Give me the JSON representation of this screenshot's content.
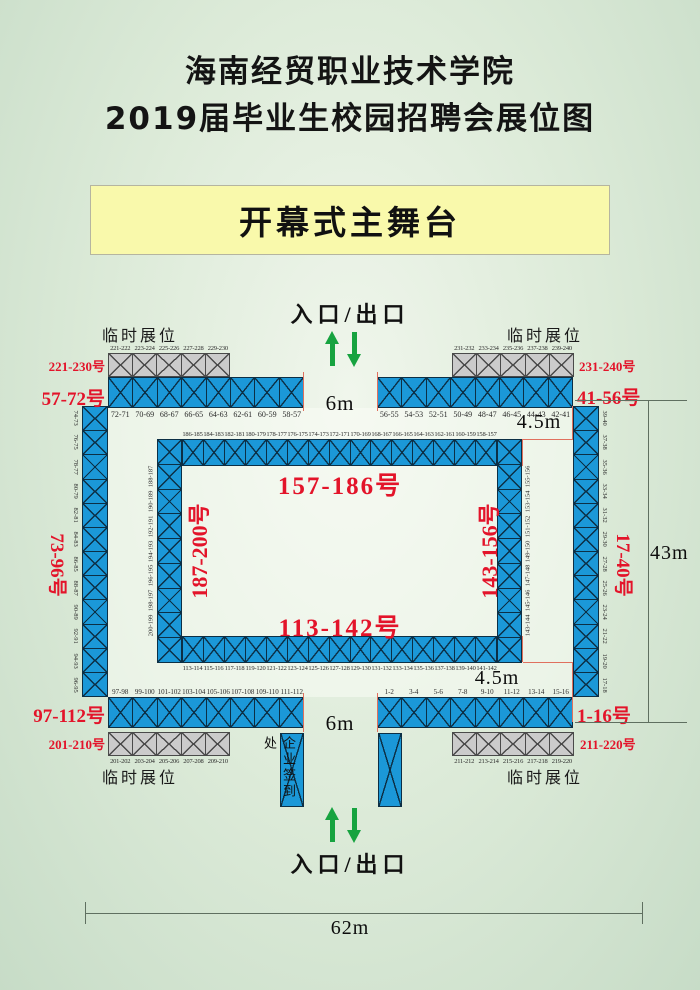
{
  "title": {
    "line1": "海南经贸职业技术学院",
    "line2": "2019届毕业生校园招聘会展位图"
  },
  "stage": {
    "label": "开幕式主舞台"
  },
  "entrance": {
    "top": "入口/出口",
    "bottom": "入口/出口"
  },
  "checkin": {
    "label": "企业签到处"
  },
  "labels": {
    "temp": "临时展位"
  },
  "dims": {
    "gap_top": "6m",
    "gap_bottom": "6m",
    "aisle_top": "4.5m",
    "aisle_bottom": "4.5m",
    "height": "43m",
    "width": "62m"
  },
  "zones": {
    "temp_top_left": {
      "range": "221-230号",
      "cells": [
        "221-222",
        "223-224",
        "225-226",
        "227-228",
        "229-230"
      ]
    },
    "temp_top_right": {
      "range": "231-240号",
      "cells": [
        "231-232",
        "233-234",
        "235-236",
        "237-238",
        "239-240"
      ]
    },
    "temp_bottom_left": {
      "range": "201-210号",
      "cells": [
        "201-202",
        "203-204",
        "205-206",
        "207-208",
        "209-210"
      ]
    },
    "temp_bottom_right": {
      "range": "211-220号",
      "cells": [
        "211-212",
        "213-214",
        "215-216",
        "217-218",
        "219-220"
      ]
    },
    "outer_top_left": {
      "range": "57-72号",
      "cells": [
        "72-71",
        "70-69",
        "68-67",
        "66-65",
        "64-63",
        "62-61",
        "60-59",
        "58-57"
      ]
    },
    "outer_top_right": {
      "range": "41-56号",
      "cells": [
        "56-55",
        "54-53",
        "52-51",
        "50-49",
        "48-47",
        "46-45",
        "44-43",
        "42-41"
      ]
    },
    "outer_left": {
      "range": "73-96号",
      "cells": [
        "74-73",
        "76-75",
        "78-77",
        "80-79",
        "82-81",
        "84-83",
        "86-85",
        "88-87",
        "90-89",
        "92-91",
        "94-93",
        "96-95"
      ]
    },
    "outer_right": {
      "range": "17-40号",
      "cells": [
        "39-40",
        "37-38",
        "35-36",
        "33-34",
        "31-32",
        "29-30",
        "27-28",
        "25-26",
        "23-24",
        "21-22",
        "19-20",
        "17-18"
      ]
    },
    "outer_bottom_left": {
      "range": "97-112号",
      "cells": [
        "97-98",
        "99-100",
        "101-102",
        "103-104",
        "105-106",
        "107-108",
        "109-110",
        "111-112"
      ]
    },
    "outer_bottom_right": {
      "range": "1-16号",
      "cells": [
        "1-2",
        "3-4",
        "5-6",
        "7-8",
        "9-10",
        "11-12",
        "13-14",
        "15-16"
      ]
    },
    "inner_top": {
      "range": "157-186号",
      "cells": [
        "186-185",
        "184-183",
        "182-181",
        "180-179",
        "178-177",
        "176-175",
        "174-173",
        "172-171",
        "170-169",
        "168-167",
        "166-165",
        "164-163",
        "162-161",
        "160-159",
        "158-157"
      ]
    },
    "inner_bottom": {
      "range": "113-142号",
      "cells": [
        "113-114",
        "115-116",
        "117-118",
        "119-120",
        "121-122",
        "123-124",
        "125-126",
        "127-128",
        "129-130",
        "131-132",
        "133-134",
        "135-136",
        "137-138",
        "139-140",
        "141-142"
      ]
    },
    "inner_left": {
      "range": "187-200号",
      "cells": [
        "188-187",
        "190-189",
        "192-191",
        "194-193",
        "196-195",
        "198-197",
        "200-199"
      ]
    },
    "inner_right": {
      "range": "143-156号",
      "cells": [
        "155-156",
        "153-154",
        "151-152",
        "149-150",
        "147-148",
        "145-146",
        "143-144"
      ]
    }
  },
  "colors": {
    "booth_blue": "#1b98d8",
    "booth_gray": "#cbcbcb",
    "label_red": "#e3142a",
    "arrow_green": "#17a340",
    "stage_yellow": "#f9f9ab"
  }
}
